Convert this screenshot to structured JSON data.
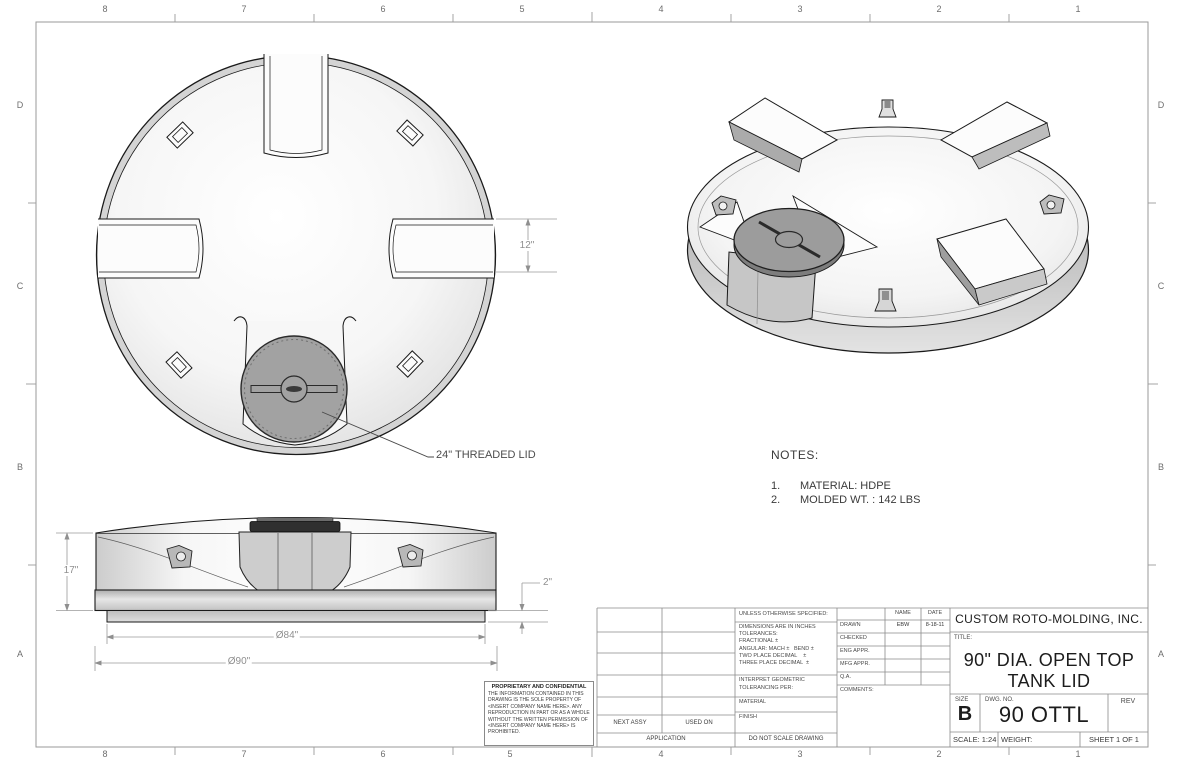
{
  "border": {
    "columns": [
      "8",
      "7",
      "6",
      "5",
      "4",
      "3",
      "2",
      "1"
    ],
    "rows": [
      "D",
      "C",
      "B",
      "A"
    ]
  },
  "dimensions": {
    "notch_width": "12\"",
    "lid_callout": "24\" THREADED LID",
    "overall_height": "17\"",
    "lip_height": "2\"",
    "inner_diameter": "Ø84\"",
    "outer_diameter": "Ø90\""
  },
  "notes": {
    "heading": "NOTES:",
    "items": [
      {
        "num": "1.",
        "text": "MATERIAL: HDPE"
      },
      {
        "num": "2.",
        "text": "MOLDED WT. : 142 LBS"
      }
    ]
  },
  "proprietary": {
    "heading": "PROPRIETARY AND CONFIDENTIAL",
    "body": "THE INFORMATION CONTAINED IN THIS DRAWING IS THE SOLE PROPERTY OF <INSERT COMPANY NAME HERE>.  ANY REPRODUCTION IN PART OR AS A WHOLE WITHOUT THE WRITTEN PERMISSION OF <INSERT COMPANY NAME HERE> IS PROHIBITED.",
    "zone_note": ""
  },
  "application": {
    "next_assy": "NEXT ASSY",
    "used_on": "USED ON",
    "label": "APPLICATION"
  },
  "tolerance_block": {
    "unless": "UNLESS OTHERWISE SPECIFIED:",
    "lines": [
      "DIMENSIONS ARE IN INCHES",
      "TOLERANCES:",
      "FRACTIONAL ±",
      "ANGULAR: MACH ±   BEND ±",
      "TWO PLACE DECIMAL    ±",
      "THREE PLACE DECIMAL  ±"
    ],
    "interpret_line1": "INTERPRET GEOMETRIC",
    "interpret_line2": "TOLERANCING PER:",
    "material": "MATERIAL",
    "finish": "FINISH",
    "do_not_scale": "DO NOT SCALE DRAWING"
  },
  "approvals": {
    "name_header": "NAME",
    "date_header": "DATE",
    "rows": [
      {
        "label": "DRAWN",
        "name": "EBW",
        "date": "8-18-11"
      },
      {
        "label": "CHECKED",
        "name": "",
        "date": ""
      },
      {
        "label": "ENG APPR.",
        "name": "",
        "date": ""
      },
      {
        "label": "MFG APPR.",
        "name": "",
        "date": ""
      },
      {
        "label": "Q.A.",
        "name": "",
        "date": ""
      },
      {
        "label": "COMMENTS:",
        "name": "",
        "date": ""
      }
    ]
  },
  "title_block": {
    "company": "CUSTOM ROTO-MOLDING, INC.",
    "title_label": "TITLE:",
    "title_line1": "90\" DIA. OPEN TOP",
    "title_line2": "TANK LID",
    "size_label": "SIZE",
    "size": "B",
    "dwg_label": "DWG.  NO.",
    "dwg_no": "90 OTTL",
    "rev_label": "REV",
    "scale": "SCALE: 1:24",
    "weight_label": "WEIGHT:",
    "sheet": "SHEET 1 OF 1"
  }
}
